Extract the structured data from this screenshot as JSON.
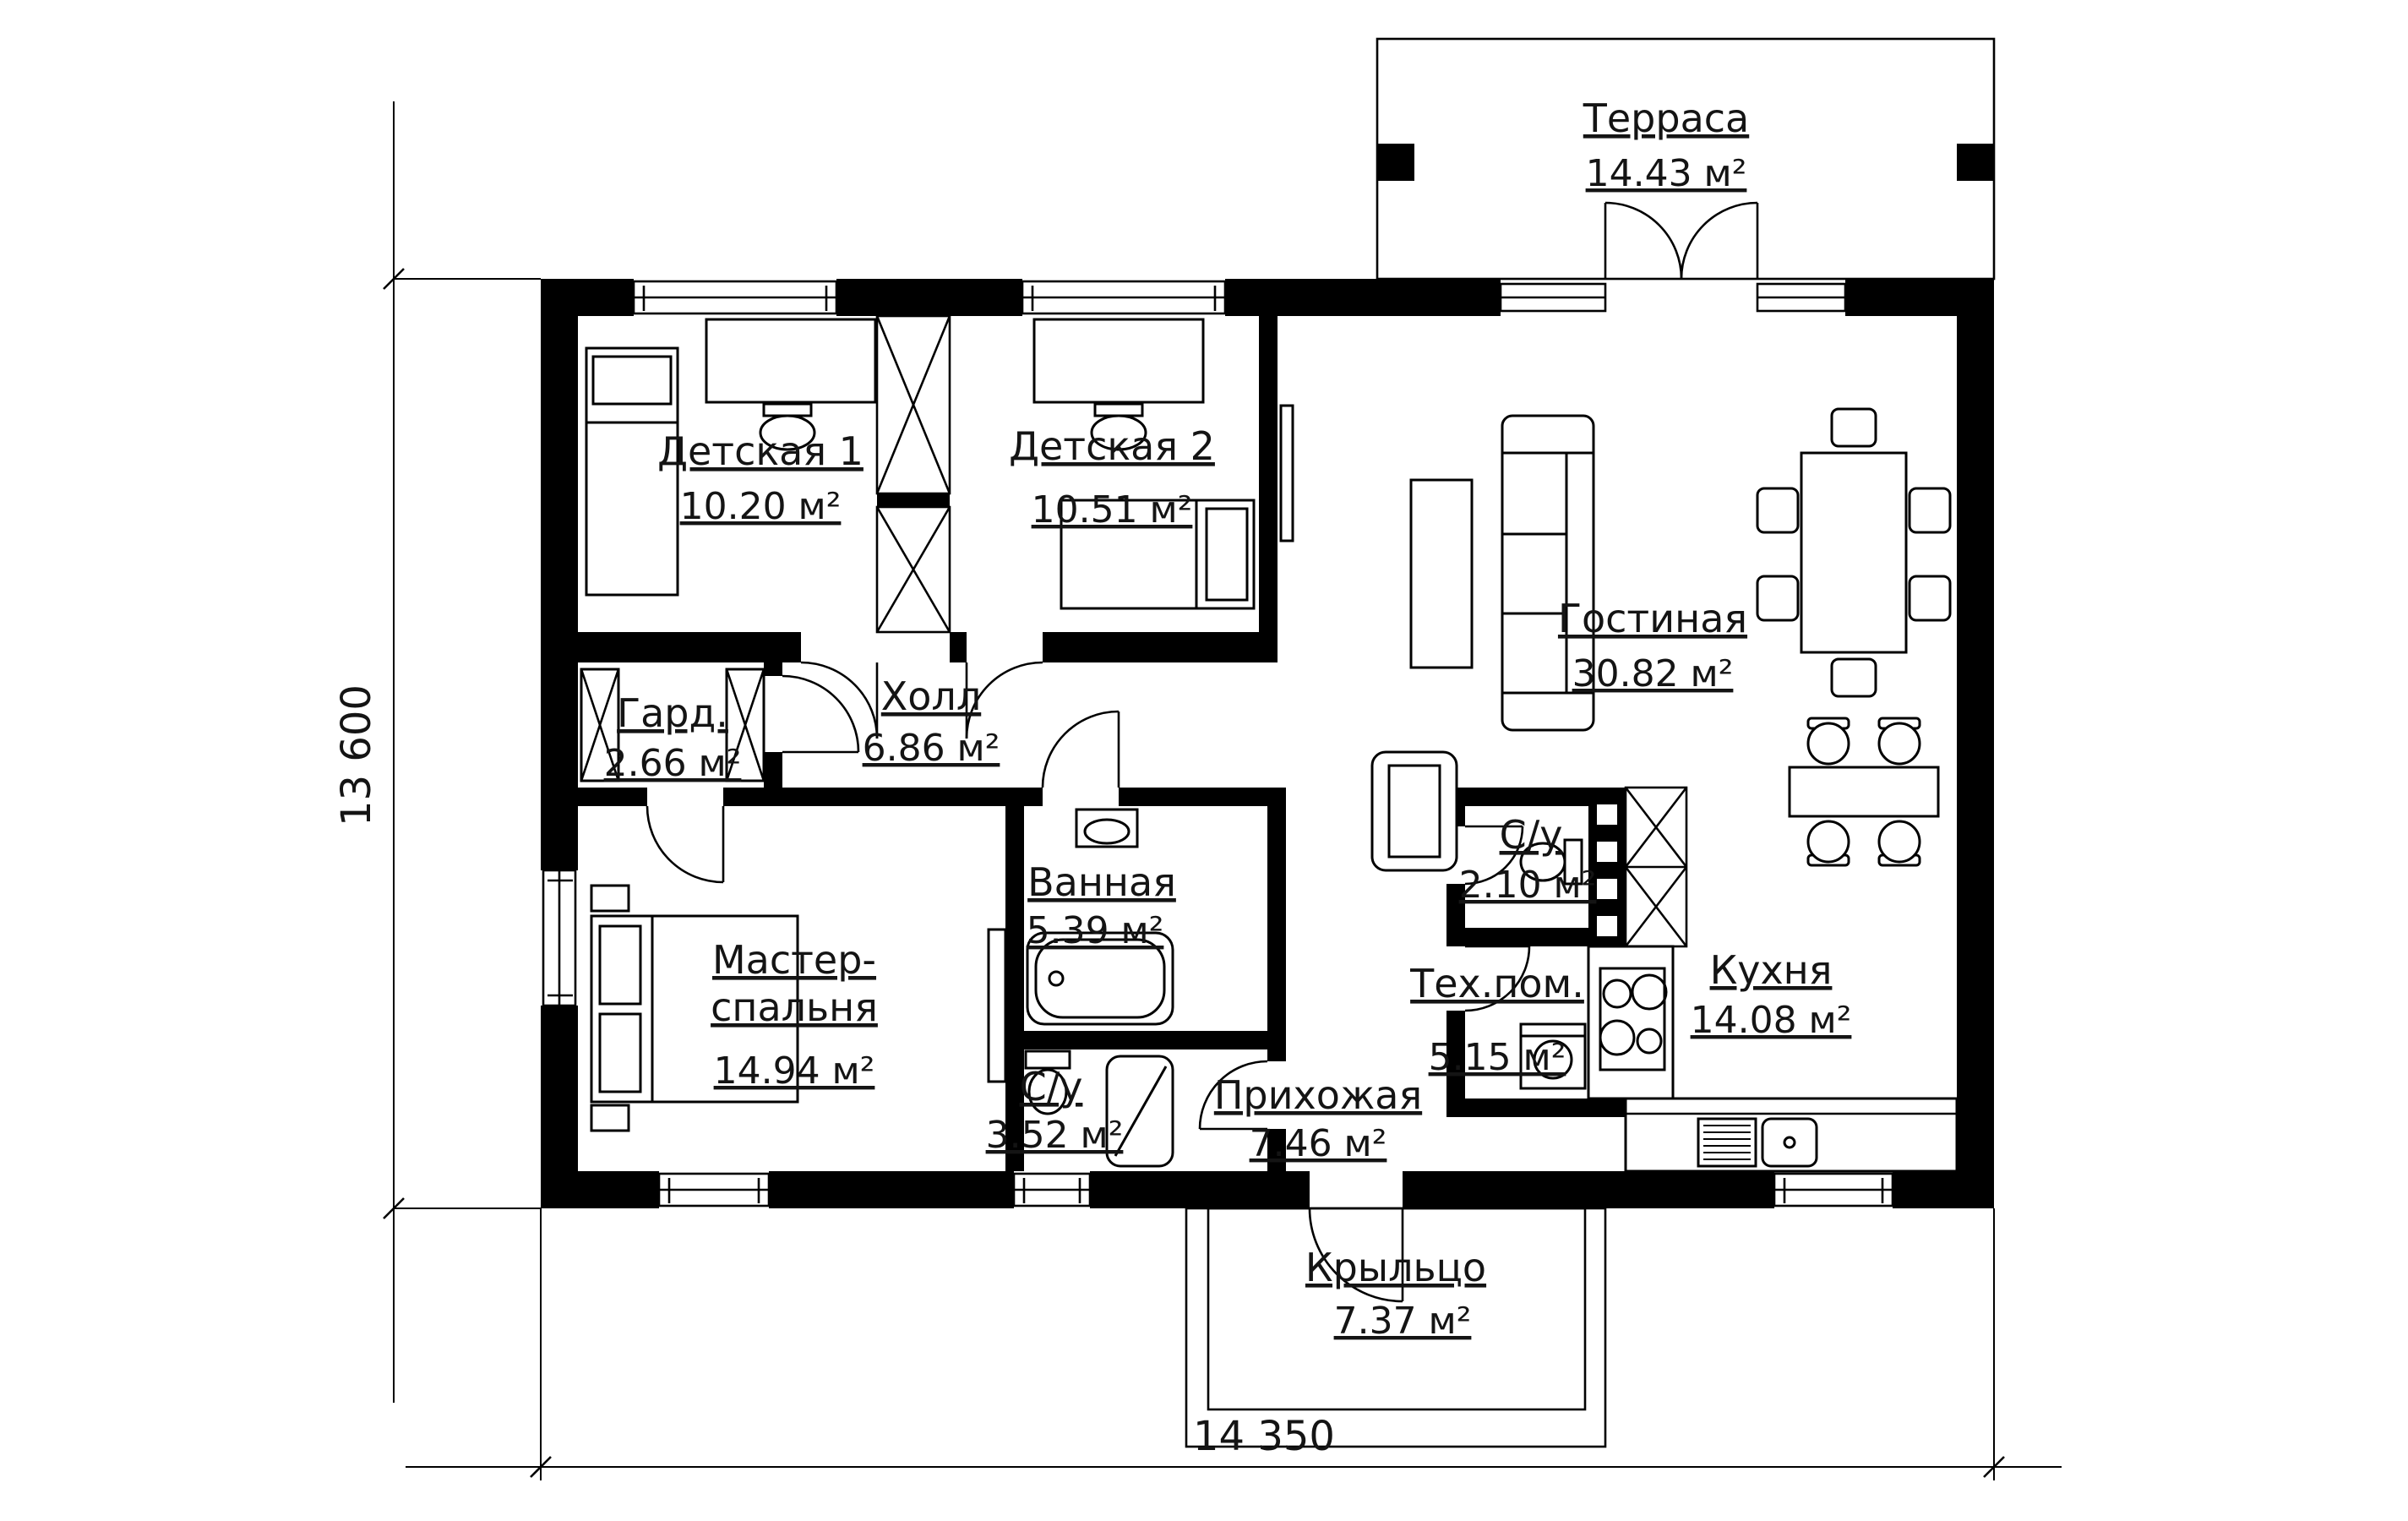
{
  "rooms": [
    {
      "id": "terrace",
      "name": "Терраса",
      "area": "14.43 м²"
    },
    {
      "id": "kids1",
      "name": "Детская 1",
      "area": "10.20 м²"
    },
    {
      "id": "kids2",
      "name": "Детская 2",
      "area": "10.51 м²"
    },
    {
      "id": "living",
      "name": "Гостиная",
      "area": "30.82 м²"
    },
    {
      "id": "wardrobe",
      "name": "Гард.",
      "area": "2.66 м²"
    },
    {
      "id": "hall",
      "name": "Холл",
      "area": "6.86 м²"
    },
    {
      "id": "wc-small",
      "name": "С/у",
      "area": "2.10 м²"
    },
    {
      "id": "master",
      "name_line1": "Мастер-",
      "name_line2": "спальня",
      "area": "14.94 м²"
    },
    {
      "id": "bathroom",
      "name": "Ванная",
      "area": "5.39 м²"
    },
    {
      "id": "tech",
      "name": "Тех.пом.",
      "area": "5.15 м²"
    },
    {
      "id": "kitchen",
      "name": "Кухня",
      "area": "14.08 м²"
    },
    {
      "id": "entry",
      "name": "Прихожая",
      "area": "7.46 м²"
    },
    {
      "id": "wc-big",
      "name": "С/у",
      "area": "3.52 м²"
    },
    {
      "id": "porch",
      "name": "Крыльцо",
      "area": "7.37 м²"
    }
  ],
  "dimensions": {
    "vertical": "13 600",
    "horizontal": "14 350"
  },
  "colors": {
    "ink": "#000000",
    "paper": "#ffffff"
  }
}
